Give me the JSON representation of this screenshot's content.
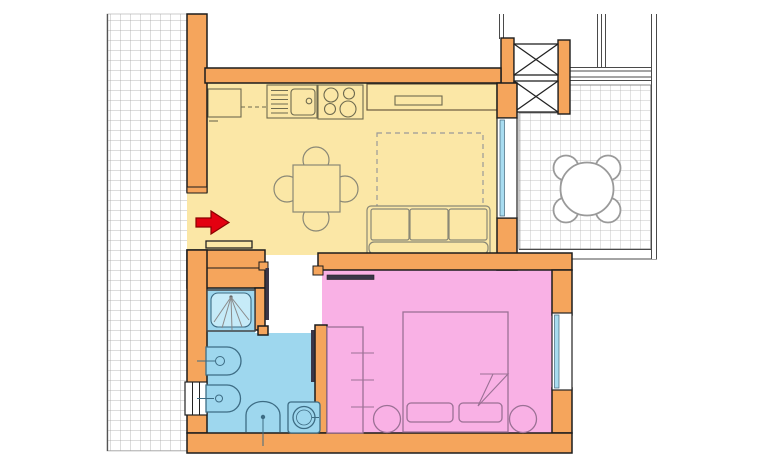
{
  "canvas": {
    "width": 769,
    "height": 462
  },
  "colors": {
    "background": "#FFFFFF",
    "wall_fill": "#F5A55C",
    "wall_outline": "#1C1C1C",
    "living_floor": "#FBE7A6",
    "bath_floor": "#9ED7EE",
    "shower_tray": "#C6EBF8",
    "bedroom_floor": "#F9B1E5",
    "glass": "#A8DCF0",
    "window_frame": "#222222",
    "kitchen_line": "#6E6A4F",
    "counter_outline": "#6B5B3F",
    "living_line": "#8A8876",
    "bath_line": "#3D6C84",
    "bedroom_line": "#9B7195",
    "door_leaf": "#3A3648",
    "arrow_fill": "#E30010",
    "arrow_outline": "#8B0000",
    "railing": "#4A4A4A",
    "tile_grid_walkway": "#9B9B9B",
    "tile_grid_balcony": "#ADADAD",
    "spray_line": "#8A8A8A",
    "table_line": "#9A9A9A"
  },
  "floor_plan": {
    "type": "apartment-floor-plan",
    "rooms": [
      {
        "id": "living-kitchen",
        "floor_color": "#FBE7A6",
        "furniture": [
          "kitchen-base-cabinet",
          "kitchen-sink-with-drainer",
          "cooktop-4-burners",
          "wall-cabinet-with-shelf",
          "square-dining-table-4-chairs",
          "sofa-3-seat",
          "sofa-bed-dashed-outline"
        ]
      },
      {
        "id": "bathroom",
        "floor_color": "#9ED7EE",
        "has_window": true,
        "furniture": [
          "shower",
          "bidet",
          "toilet",
          "washbasin",
          "washing-machine"
        ]
      },
      {
        "id": "bedroom",
        "floor_color": "#F9B1E5",
        "has_window": true,
        "furniture": [
          "wardrobe",
          "double-bed",
          "pillow-left",
          "pillow-right",
          "sheet-fold",
          "nightstand-left",
          "nightstand-right"
        ]
      },
      {
        "id": "hallway",
        "floor_color": "#FFFFFF",
        "furniture": []
      },
      {
        "id": "balcony",
        "floor": "tiled-grid",
        "furniture": [
          "round-table-4-chairs"
        ]
      },
      {
        "id": "walkway-left",
        "floor": "tiled-grid",
        "furniture": []
      }
    ],
    "doors": [
      "entrance-door",
      "living-to-hallway-door",
      "hallway-to-bathroom-door",
      "hallway-to-bedroom-door",
      "balcony-glass-door"
    ],
    "structure": [
      "cross-braced-pillar-upper",
      "cross-braced-pillar-lower",
      "balcony-railing",
      "upper-railing-lines"
    ],
    "indicators": {
      "entrance_arrow": {
        "direction": "right",
        "color": "#E30010"
      }
    }
  }
}
